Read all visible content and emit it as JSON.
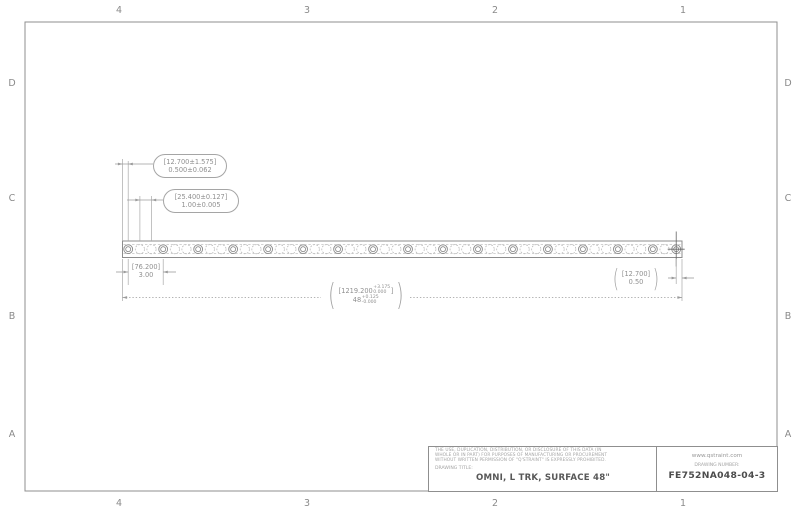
{
  "sheet": {
    "cols": [
      "4",
      "3",
      "2",
      "1"
    ],
    "rows": [
      "D",
      "C",
      "B",
      "A"
    ]
  },
  "dimensions": {
    "end_offset": {
      "metric": "[12.700±1.575]",
      "inch": "0.500±0.062"
    },
    "pitch": {
      "metric": "[25.400±0.127]",
      "inch": "1.00±0.005"
    },
    "bolt_spacing": {
      "metric": "[76.200]",
      "inch": "3.00"
    },
    "right_end": {
      "metric": "[12.700]",
      "inch": "0.50"
    },
    "overall": {
      "metric_open": "[1219.200",
      "metric_plus": "+3.175",
      "metric_minus": "0.000",
      "metric_close": "]",
      "inch_value": "48",
      "inch_plus": "+0.125",
      "inch_minus": "-0.000"
    }
  },
  "notation": {
    "paren_open": "(",
    "paren_close": ")"
  },
  "title_block": {
    "legal_line1": "THE USE, DUPLICATION, DISTRIBUTION, OR DISCLOSURE OF THIS DATA (IN",
    "legal_line2": "WHOLE OR IN PART) FOR PURPOSES OF MANUFACTURING OR PROCUREMENT",
    "legal_line3": "WITHOUT WRITTEN PERMISSION OF \"Q'STRAINT\" IS EXPRESSLY PROHIBITED.",
    "drawing_title_label": "DRAWING TITLE:",
    "drawing_title": "OMNI, L TRK, SURFACE 48\"",
    "website": "www.qstraint.com",
    "drawing_number_label": "DRAWING NUMBER:",
    "drawing_number": "FE752NA048-04-3"
  },
  "colors": {
    "line": "#9b9b9b",
    "text": "#8f8f8f",
    "dark_text": "#4c4c4c"
  }
}
